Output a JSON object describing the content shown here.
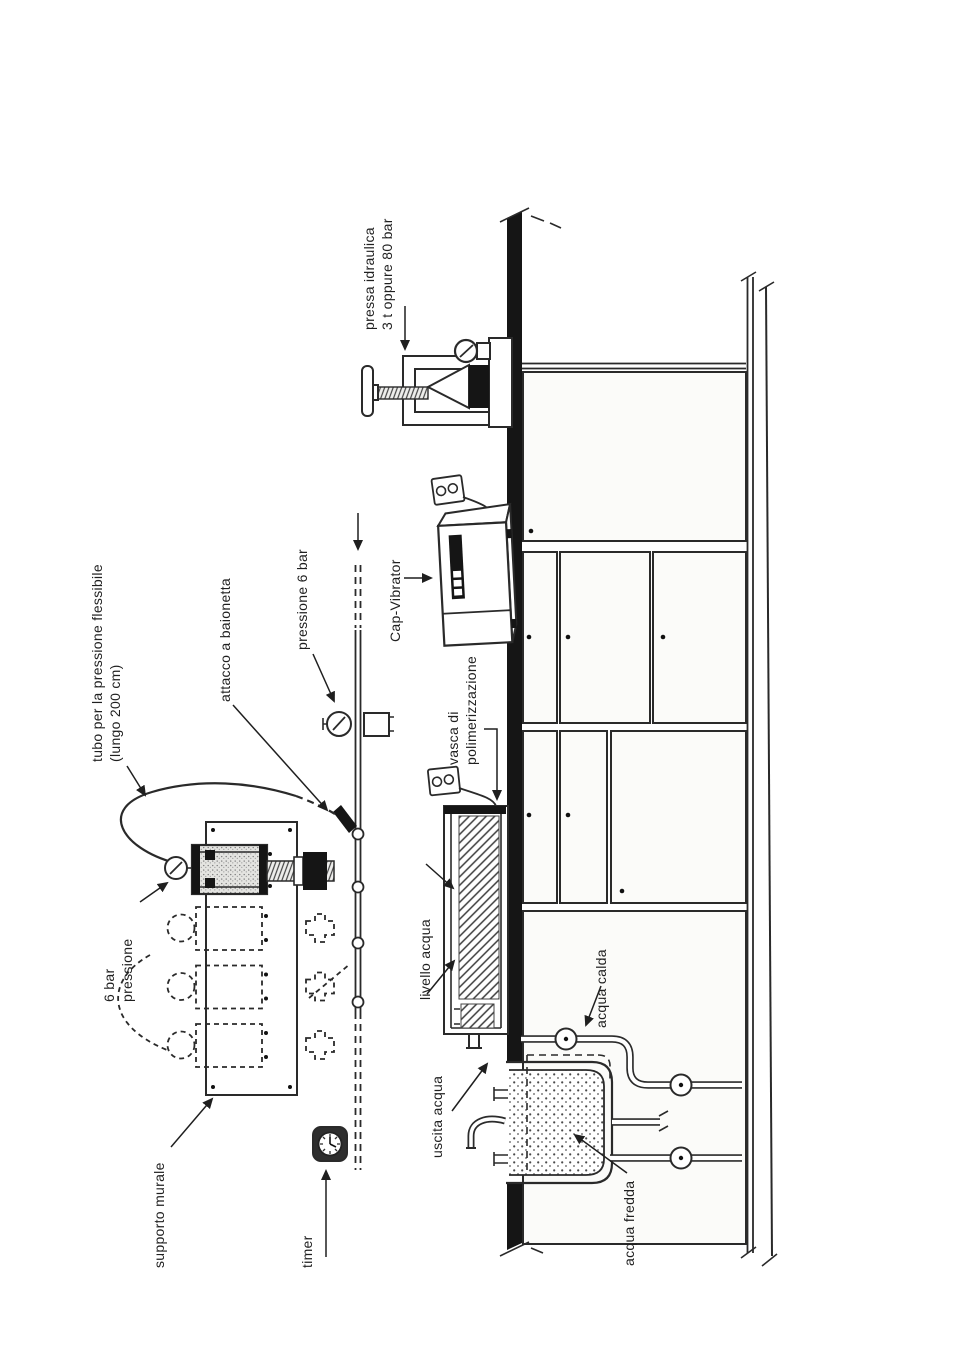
{
  "colors": {
    "ink": "#262626",
    "paper": "#ffffff",
    "bench": "#1b1b1b"
  },
  "labels": {
    "pressa": {
      "line1": "pressa idraulica",
      "line2": "3 t oppure 80 bar"
    },
    "cap_vibrator": {
      "line1": "Cap-Vibrator"
    },
    "vasca": {
      "line1": "vasca di",
      "line2": "polimerizzazione"
    },
    "livello_acqua": {
      "line1": "livello acqua"
    },
    "acqua_calda": {
      "line1": "acqua calda"
    },
    "acqua_fredda": {
      "line1": "acqua fredda"
    },
    "uscita_acqua": {
      "line1": "uscita acqua"
    },
    "pressione_6_bar": {
      "line1": "pressione 6 bar"
    },
    "attacco": {
      "line1": "attacco a baionetta"
    },
    "tubo": {
      "line1": "tubo per la pressione flessibile",
      "line2": "(lungo 200 cm)"
    },
    "sei_bar": {
      "line1": "6 bar",
      "line2": "pressione"
    },
    "supporto_murale": {
      "line1": "supporto murale"
    },
    "timer": {
      "line1": "timer"
    }
  }
}
